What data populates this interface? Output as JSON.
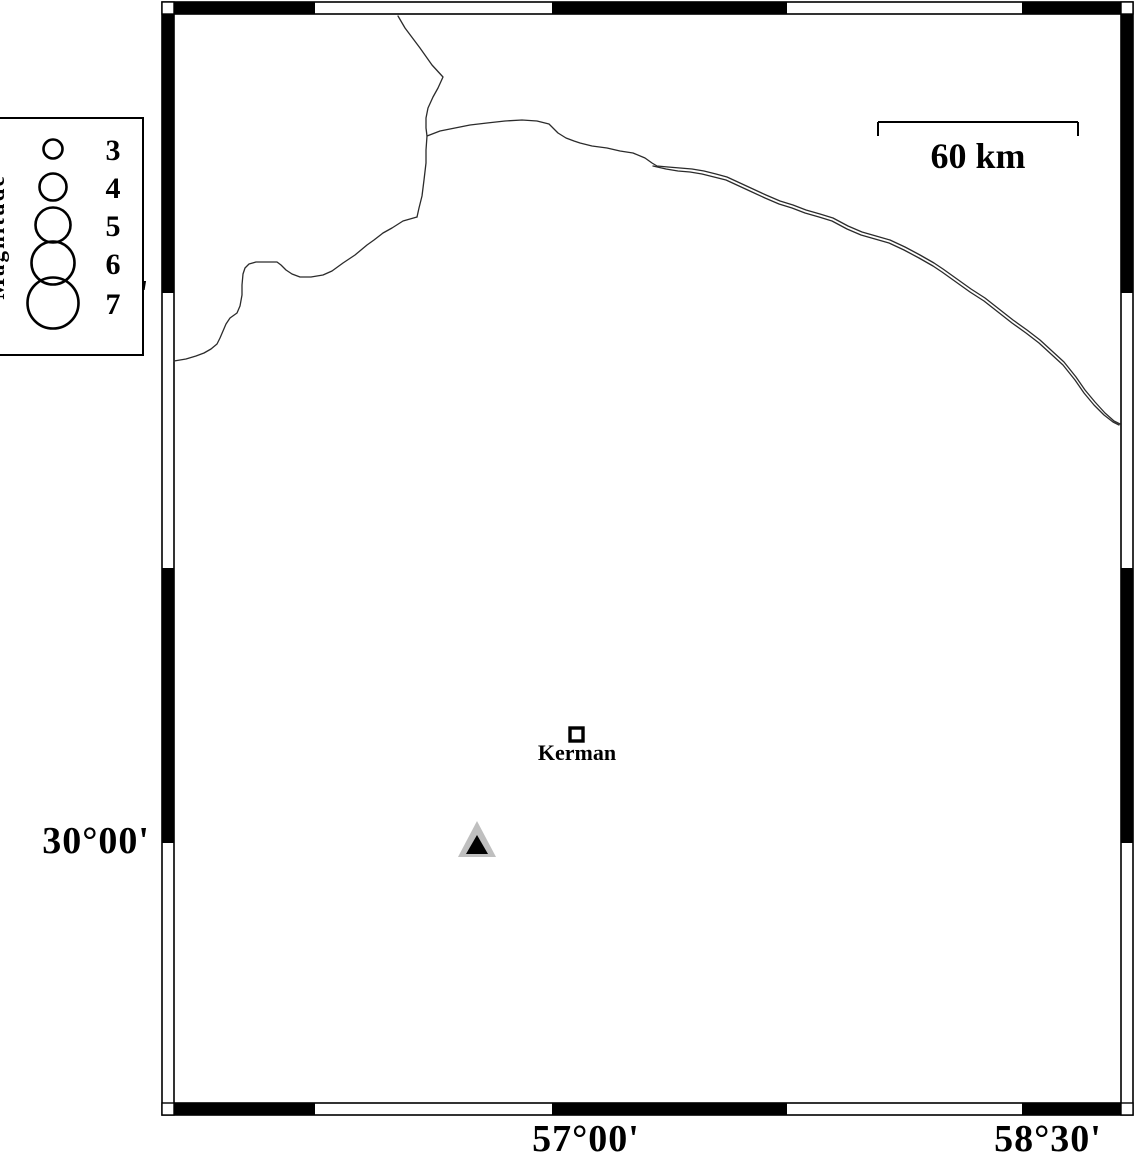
{
  "figure": {
    "type": "seismicity-map",
    "colors": {
      "ink": "#000000",
      "coast": "#2b2b2b",
      "station_fill": "#bfbfbf"
    },
    "legend": {
      "title": "Magnitude",
      "entries": [
        {
          "label": "3"
        },
        {
          "label": "4"
        },
        {
          "label": "5"
        },
        {
          "label": "6"
        },
        {
          "label": "7"
        }
      ]
    },
    "scale_bar": {
      "label": "60 km"
    },
    "city": {
      "name": "Kerman"
    },
    "axis": {
      "lat_left": [
        "30°00'",
        "31°30'"
      ],
      "lon_bottom": [
        "57°00'",
        "58°30'"
      ]
    }
  }
}
